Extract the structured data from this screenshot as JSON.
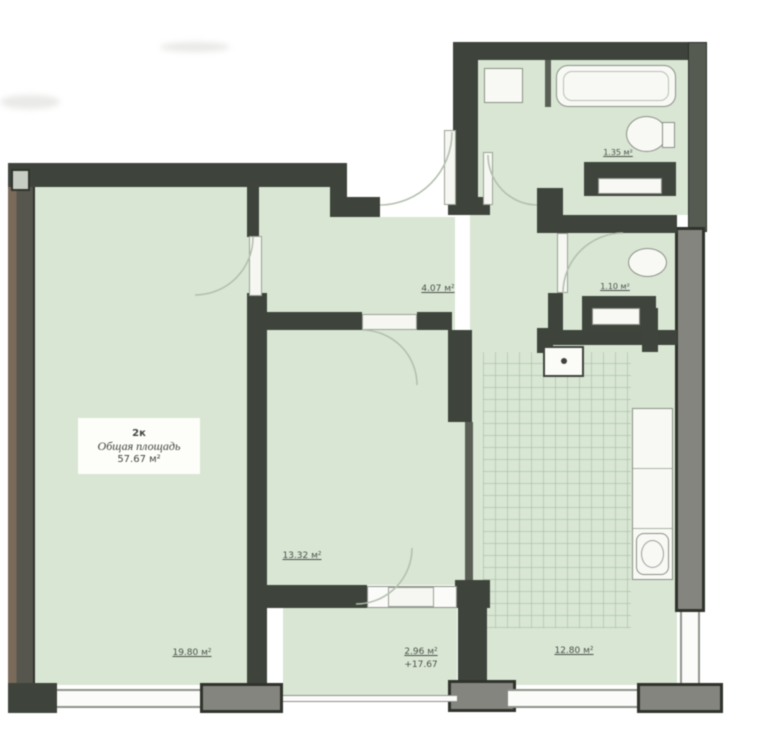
{
  "plan": {
    "type": "apartment-floor-plan",
    "unit_label": {
      "line1": "2к",
      "line2": "Общая площадь",
      "line3": "57.67 м²"
    },
    "rooms": {
      "living": {
        "name": "living-room",
        "area": "19.80 м²"
      },
      "bedroom": {
        "name": "bedroom",
        "area": "13.32 м²"
      },
      "hallway": {
        "name": "hallway",
        "area": "4.07 м²"
      },
      "bathroom_top": {
        "name": "bathroom",
        "area": "1.35 м²"
      },
      "bathroom_bottom": {
        "name": "wc",
        "area": "1.10 м²"
      },
      "kitchen": {
        "name": "kitchen",
        "area": "12.80 м²"
      },
      "balcony": {
        "name": "balcony",
        "area": "2.96 м²",
        "elevation": "+17.67"
      }
    },
    "colors": {
      "room_fill": "#d9e6d4",
      "wall_dark": "#3e433b",
      "wall_gray": "#83857e",
      "wall_brown": "#7a6a59",
      "tile_line": "#8aa885",
      "door_arc": "#b3c0ae"
    }
  }
}
